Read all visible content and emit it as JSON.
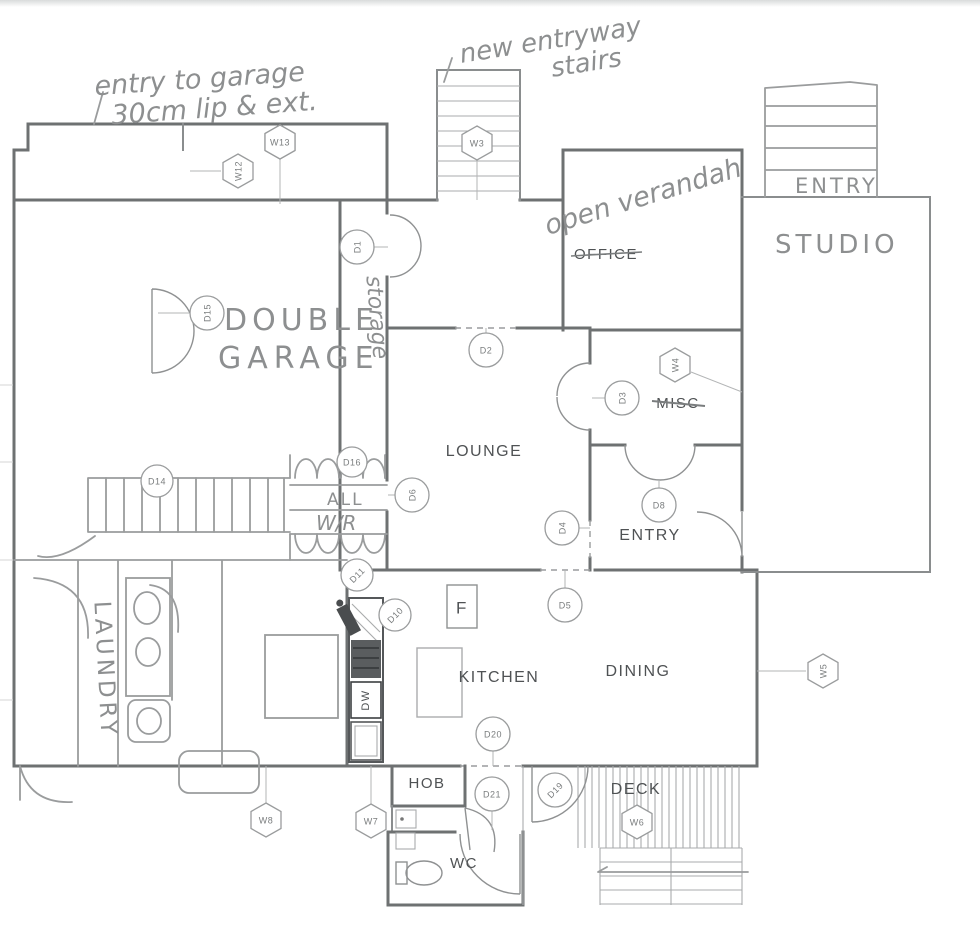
{
  "annotations": {
    "garage_note_1": "entry to garage",
    "garage_note_2": "30cm lip & ext.",
    "entry_note_1": "new entryway",
    "entry_note_2": "stairs",
    "verandah_note": "open verandah",
    "studio_entry": "ENTRY",
    "studio": "STUDIO",
    "garage_1": "DOUBLE",
    "garage_2": "GARAGE",
    "storage": "storage",
    "laundry": "LAUNDRY",
    "hall": "ALL",
    "wardrobe": "W/R"
  },
  "rooms": {
    "office": "OFFICE",
    "lounge": "LOUNGE",
    "misc": "MISC",
    "entry": "ENTRY",
    "kitchen": "KITCHEN",
    "dining": "DINING",
    "hob": "HOB",
    "deck": "DECK",
    "wc": "WC",
    "fridge": "F",
    "dishwasher": "DW"
  },
  "markers": {
    "w13": "W13",
    "w12": "W12",
    "w3": "W3",
    "w4": "W4",
    "w5": "W5",
    "w6": "W6",
    "w7": "W7",
    "w8": "W8",
    "d1": "D1",
    "d2": "D2",
    "d3": "D3",
    "d4": "D4",
    "d5": "D5",
    "d6": "D6",
    "d8": "D8",
    "d10": "D10",
    "d11": "D11",
    "d14": "D14",
    "d15": "D15",
    "d16": "D16",
    "d19": "D19",
    "d20": "D20",
    "d21": "D21"
  },
  "colors": {
    "wall": "#6e7172",
    "pencil": "#9a9c9d",
    "handwriting": "#8d8f90",
    "cad_text": "#4f5254",
    "paper": "#ffffff"
  }
}
